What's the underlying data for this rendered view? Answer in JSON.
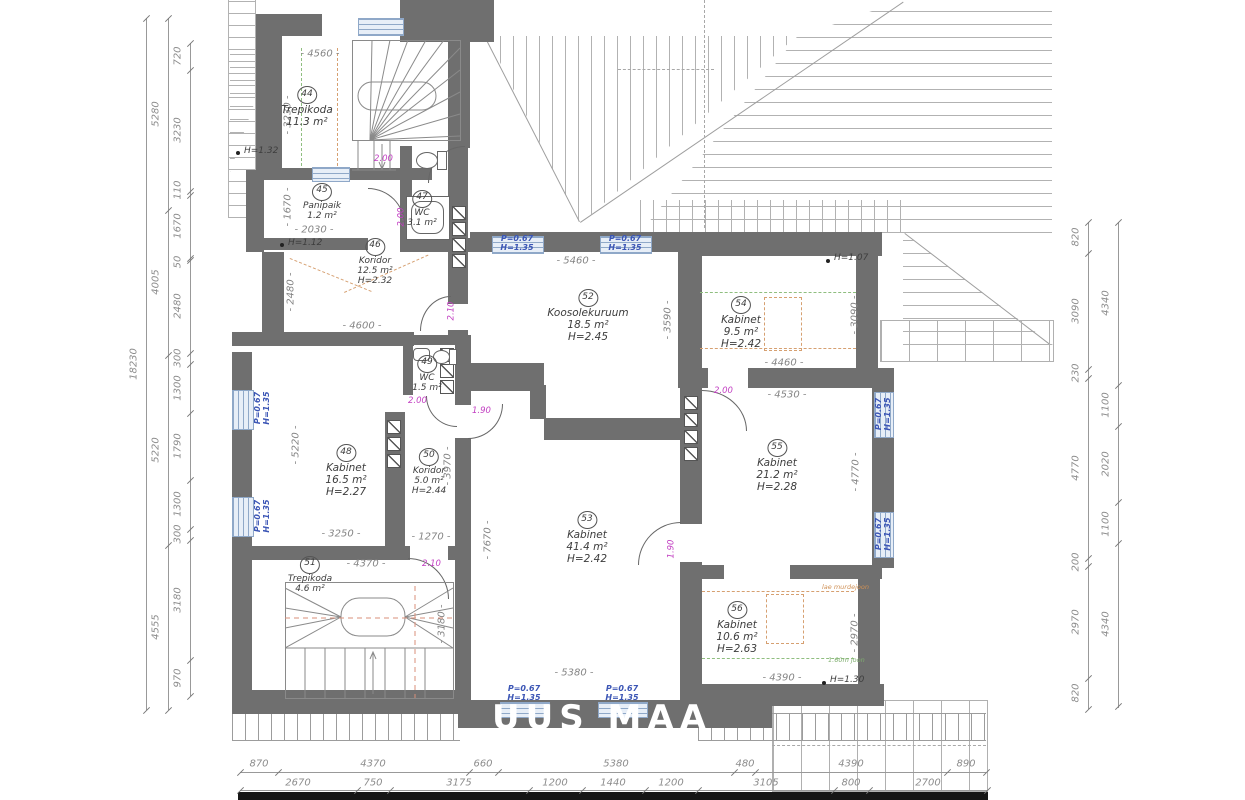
{
  "drawing": {
    "watermark": "UUS MAA",
    "wall_color": "#6f6f6f",
    "accent_magenta": "#c23fc2",
    "accent_blue": "#3b55b5"
  },
  "rooms": {
    "r44": {
      "num": "44",
      "name": "Trepikoda",
      "area": "11.3 m²"
    },
    "r45": {
      "num": "45",
      "name": "Panipaik",
      "area": "1.2 m²"
    },
    "r46": {
      "num": "46",
      "name": "Koridor",
      "area": "12.5 m²",
      "height": "H=2.32"
    },
    "r47": {
      "num": "47",
      "name": "WC",
      "area": "3.1 m²"
    },
    "r48": {
      "num": "48",
      "name": "Kabinet",
      "area": "16.5 m²",
      "height": "H=2.27"
    },
    "r49": {
      "num": "49",
      "name": "WC",
      "area": "1.5 m²"
    },
    "r50": {
      "num": "50",
      "name": "Koridor",
      "area": "5.0 m²",
      "height": "H=2.44"
    },
    "r51": {
      "num": "51",
      "name": "Trepikoda",
      "area": "4.6 m²"
    },
    "r52": {
      "num": "52",
      "name": "Koosolekuruum",
      "area": "18.5 m²",
      "height": "H=2.45"
    },
    "r53": {
      "num": "53",
      "name": "Kabinet",
      "area": "41.4 m²",
      "height": "H=2.42"
    },
    "r54": {
      "num": "54",
      "name": "Kabinet",
      "area": "9.5 m²",
      "height": "H=2.42"
    },
    "r55": {
      "num": "55",
      "name": "Kabinet",
      "area": "21.2 m²",
      "height": "H=2.28"
    },
    "r56": {
      "num": "56",
      "name": "Kabinet",
      "area": "10.6 m²",
      "height": "H=2.63"
    }
  },
  "interior_dims": {
    "r44_w": "- 4560 -",
    "r44_h": "- 3230 -",
    "r45_h": "- 1670 -",
    "r45_w": "- 2030 -",
    "r46_h": "- 2480 -",
    "r46_w": "- 4600 -",
    "r48_h": "- 5220 -",
    "r48_w": "- 3250 -",
    "r50_h": "- 3970 -",
    "r50_w": "- 1270 -",
    "r51_w": "- 4370 -",
    "r51_h": "- 3180 -",
    "r52_w": "- 5460 -",
    "r52_h": "- 3590 -",
    "r53_h": "- 7670 -",
    "r53_w": "- 5380 -",
    "r54_w": "- 4460 -",
    "r54_h": "- 3090 -",
    "r55_w": "- 4530 -",
    "r55_h": "- 4770 -",
    "r56_w": "- 4390 -",
    "r56_h": "- 2970 -"
  },
  "markers": {
    "h132": "H=1.32",
    "h112": "H=1.12",
    "h107": "H=1.07",
    "h130": "H=1.30",
    "lae_murdejoon": "lae murdejoon",
    "joon160": "1.60m joon"
  },
  "doors": {
    "d44": "2.00",
    "d45": "2.00",
    "d46": "2.10",
    "d49": "2.00",
    "d50": "1.90",
    "d51": "2.10",
    "d53": "1.90",
    "d55": "2.00"
  },
  "windows": {
    "label_p": "P=0.67",
    "label_h": "H=1.35"
  },
  "dims": {
    "left_outer": "18230",
    "left_mid": [
      "5280",
      "4005",
      "5220",
      "4555"
    ],
    "left_inner": [
      "720",
      "3230",
      "110",
      "1670",
      "50",
      "2480",
      "300",
      "1300",
      "1790",
      "1300",
      "300",
      "3180",
      "970"
    ],
    "right_inner": [
      "820",
      "3090",
      "230",
      "4770",
      "200",
      "2970",
      "820"
    ],
    "right_outer": [
      "4340",
      "1100",
      "2020",
      "1100",
      "4340"
    ],
    "bottom_upper": [
      "870",
      "4370",
      "660",
      "5380",
      "480",
      "4390",
      "890"
    ],
    "bottom_lower": [
      "2670",
      "750",
      "3175",
      "1200",
      "1440",
      "1200",
      "3105",
      "800",
      "2700"
    ]
  }
}
